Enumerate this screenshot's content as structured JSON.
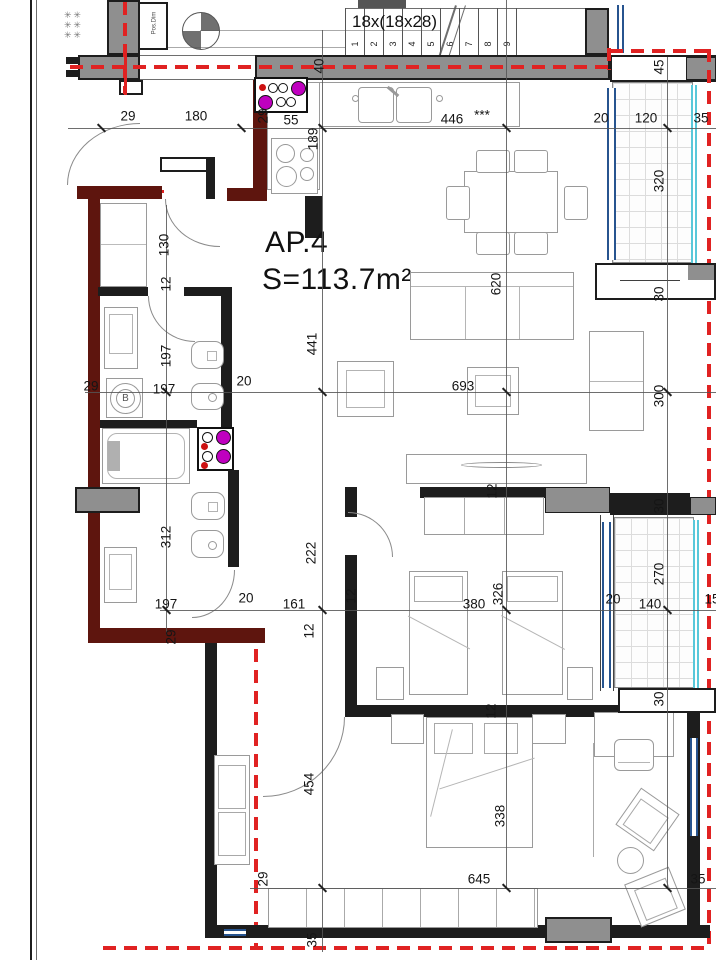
{
  "plan": {
    "apartment_label": "AP.4",
    "area_label": "S=113.7m²",
    "boiler_label": "B",
    "shaft_label": "Pos.Dim",
    "star_marks": "✳ ✳",
    "colors": {
      "wall_black": "#1d1d1d",
      "wall_gray": "#8f8f8f",
      "wall_dark_red": "#5e150e",
      "installation_red_dash": "#e02222",
      "window_blue": "#27548f",
      "glazing_cyan": "#58c8da",
      "riser_magenta": "#bf00bf",
      "riser_red_dot": "#cc1111"
    }
  },
  "staircase": {
    "label": "18x(18x28)",
    "numbers": [
      "1",
      "2",
      "3",
      "4",
      "5",
      "6",
      "7",
      "8",
      "9"
    ]
  },
  "dimensions": [
    {
      "t": "29",
      "x": 128,
      "y": 116,
      "r": 0
    },
    {
      "t": "180",
      "x": 196,
      "y": 116,
      "r": 0
    },
    {
      "t": "29",
      "x": 263,
      "y": 116,
      "r": 1
    },
    {
      "t": "55",
      "x": 291,
      "y": 120,
      "r": 0
    },
    {
      "t": "40",
      "x": 319,
      "y": 66,
      "r": 1
    },
    {
      "t": "446",
      "x": 452,
      "y": 119,
      "r": 0
    },
    {
      "t": "***",
      "x": 482,
      "y": 115,
      "r": 0
    },
    {
      "t": "20",
      "x": 601,
      "y": 118,
      "r": 0
    },
    {
      "t": "120",
      "x": 646,
      "y": 118,
      "r": 0
    },
    {
      "t": "35",
      "x": 701,
      "y": 118,
      "r": 0
    },
    {
      "t": "45",
      "x": 659,
      "y": 67,
      "r": 1
    },
    {
      "t": "189",
      "x": 313,
      "y": 139,
      "r": 1
    },
    {
      "t": "130",
      "x": 164,
      "y": 245,
      "r": 1
    },
    {
      "t": "12",
      "x": 166,
      "y": 284,
      "r": 1
    },
    {
      "t": "197",
      "x": 166,
      "y": 356,
      "r": 1
    },
    {
      "t": "197",
      "x": 164,
      "y": 389,
      "r": 0
    },
    {
      "t": "20",
      "x": 244,
      "y": 381,
      "r": 0
    },
    {
      "t": "29",
      "x": 91,
      "y": 386,
      "r": 0
    },
    {
      "t": "441",
      "x": 312,
      "y": 344,
      "r": 1
    },
    {
      "t": "620",
      "x": 496,
      "y": 284,
      "r": 1
    },
    {
      "t": "693",
      "x": 463,
      "y": 386,
      "r": 0
    },
    {
      "t": "320",
      "x": 659,
      "y": 181,
      "r": 1
    },
    {
      "t": "30",
      "x": 659,
      "y": 294,
      "r": 1
    },
    {
      "t": "300",
      "x": 659,
      "y": 396,
      "r": 1
    },
    {
      "t": "30",
      "x": 659,
      "y": 506,
      "r": 1
    },
    {
      "t": "270",
      "x": 659,
      "y": 574,
      "r": 1
    },
    {
      "t": "140",
      "x": 650,
      "y": 604,
      "r": 0
    },
    {
      "t": "20",
      "x": 613,
      "y": 599,
      "r": 0
    },
    {
      "t": "15",
      "x": 712,
      "y": 599,
      "r": 0
    },
    {
      "t": "30",
      "x": 659,
      "y": 699,
      "r": 1
    },
    {
      "t": "312",
      "x": 166,
      "y": 537,
      "r": 1
    },
    {
      "t": "197",
      "x": 166,
      "y": 604,
      "r": 0
    },
    {
      "t": "20",
      "x": 246,
      "y": 598,
      "r": 0
    },
    {
      "t": "161",
      "x": 294,
      "y": 604,
      "r": 0
    },
    {
      "t": "12",
      "x": 351,
      "y": 596,
      "r": 1
    },
    {
      "t": "29",
      "x": 171,
      "y": 637,
      "r": 1
    },
    {
      "t": "222",
      "x": 311,
      "y": 553,
      "r": 1
    },
    {
      "t": "380",
      "x": 474,
      "y": 604,
      "r": 0
    },
    {
      "t": "326",
      "x": 498,
      "y": 594,
      "r": 1
    },
    {
      "t": "12",
      "x": 309,
      "y": 631,
      "r": 1
    },
    {
      "t": "12",
      "x": 492,
      "y": 491,
      "r": 1
    },
    {
      "t": "12",
      "x": 491,
      "y": 711,
      "r": 1
    },
    {
      "t": "454",
      "x": 309,
      "y": 784,
      "r": 1
    },
    {
      "t": "338",
      "x": 500,
      "y": 816,
      "r": 1
    },
    {
      "t": "645",
      "x": 479,
      "y": 879,
      "r": 0
    },
    {
      "t": "29",
      "x": 263,
      "y": 879,
      "r": 1
    },
    {
      "t": "35",
      "x": 312,
      "y": 940,
      "r": 1
    },
    {
      "t": "35",
      "x": 698,
      "y": 879,
      "r": 0
    }
  ]
}
